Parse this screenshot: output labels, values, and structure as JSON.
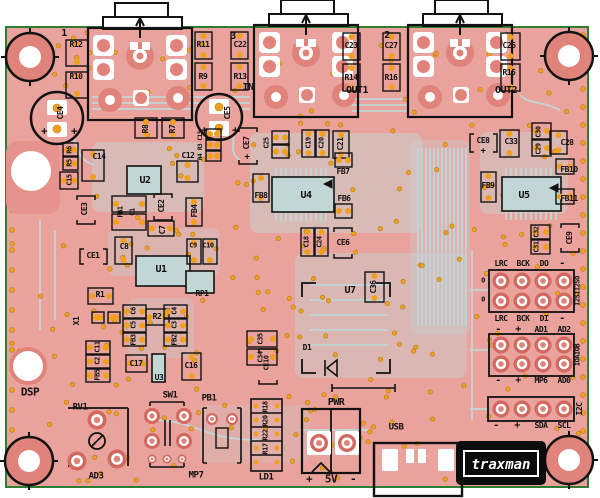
{
  "board": {
    "name": "audio DSP PCB layout",
    "colors": {
      "bg": "#ffffff",
      "board": "#e9a29c",
      "trace": "#c3d6d6",
      "pad_red": "#d4675f",
      "pad_light": "#df837b",
      "via": "#f0a01e",
      "via_ring": "#b57b12",
      "silk": "#121212",
      "white": "#ffffff",
      "edge_green": "#2f7d32"
    }
  },
  "logo": {
    "text": "traxman"
  },
  "labels": [
    {
      "id": "marker-1",
      "t": "1",
      "x": 64,
      "y": 34,
      "s": 10
    },
    {
      "id": "marker-3",
      "t": "3",
      "x": 233,
      "y": 37,
      "s": 10
    },
    {
      "id": "marker-2",
      "t": "2",
      "x": 387,
      "y": 36,
      "s": 10
    },
    {
      "id": "r12",
      "t": "R12",
      "x": 76,
      "y": 45
    },
    {
      "id": "r10",
      "t": "R10",
      "x": 76,
      "y": 77
    },
    {
      "id": "r11",
      "t": "R11",
      "x": 203,
      "y": 45
    },
    {
      "id": "r9",
      "t": "R9",
      "x": 203,
      "y": 77
    },
    {
      "id": "c22",
      "t": "C22",
      "x": 240,
      "y": 45
    },
    {
      "id": "r13",
      "t": "R13",
      "x": 240,
      "y": 77
    },
    {
      "id": "c23",
      "t": "C23",
      "x": 351,
      "y": 46
    },
    {
      "id": "c27",
      "t": "C27",
      "x": 391,
      "y": 46
    },
    {
      "id": "r14",
      "t": "R14",
      "x": 351,
      "y": 78
    },
    {
      "id": "r16",
      "t": "R16",
      "x": 391,
      "y": 78
    },
    {
      "id": "c26",
      "t": "C26",
      "x": 509,
      "y": 46
    },
    {
      "id": "r15",
      "t": "R15",
      "x": 509,
      "y": 73
    },
    {
      "id": "in",
      "t": "IN",
      "x": 248,
      "y": 88,
      "s": 10
    },
    {
      "id": "out1",
      "t": "OUT1",
      "x": 357,
      "y": 91,
      "s": 10
    },
    {
      "id": "out2",
      "t": "OUT2",
      "x": 506,
      "y": 91,
      "s": 10
    },
    {
      "id": "ce4",
      "t": "CE4",
      "x": 61,
      "y": 113,
      "r": -90
    },
    {
      "id": "ce4-plus-l",
      "t": "+",
      "x": 44,
      "y": 131,
      "s": 11
    },
    {
      "id": "ce4-plus-r",
      "t": "+",
      "x": 74,
      "y": 131,
      "s": 11
    },
    {
      "id": "ce5",
      "t": "CE5",
      "x": 228,
      "y": 113,
      "r": -90
    },
    {
      "id": "ce5-plus-l",
      "t": "+",
      "x": 204,
      "y": 130,
      "s": 11
    },
    {
      "id": "ce5-plus-r",
      "t": "+",
      "x": 235,
      "y": 130,
      "s": 11
    },
    {
      "id": "r8",
      "t": "R8",
      "x": 146,
      "y": 129,
      "r": -90
    },
    {
      "id": "r7",
      "t": "R7",
      "x": 173,
      "y": 129,
      "r": -90
    },
    {
      "id": "c13",
      "t": "C13",
      "x": 201,
      "y": 136,
      "r": -90,
      "s": 6
    },
    {
      "id": "r3",
      "t": "R3",
      "x": 201,
      "y": 147,
      "r": -90,
      "s": 6
    },
    {
      "id": "r4",
      "t": "R4",
      "x": 201,
      "y": 157,
      "r": -90,
      "s": 6
    },
    {
      "id": "ce7",
      "t": "CE7",
      "x": 247,
      "y": 143,
      "r": -90
    },
    {
      "id": "ce7-plus",
      "t": "+",
      "x": 247,
      "y": 158,
      "s": 9
    },
    {
      "id": "c25",
      "t": "C25",
      "x": 267,
      "y": 143,
      "r": -90,
      "s": 7
    },
    {
      "id": "c19",
      "t": "C19",
      "x": 309,
      "y": 143,
      "r": -90,
      "s": 7
    },
    {
      "id": "c20",
      "t": "C20",
      "x": 322,
      "y": 143,
      "r": -90,
      "s": 7
    },
    {
      "id": "c21",
      "t": "C21",
      "x": 341,
      "y": 144,
      "r": -90
    },
    {
      "id": "r6",
      "t": "R6",
      "x": 70,
      "y": 150,
      "r": -90,
      "s": 7
    },
    {
      "id": "r5",
      "t": "R5",
      "x": 70,
      "y": 163,
      "r": -90,
      "s": 7
    },
    {
      "id": "c15",
      "t": "C15",
      "x": 70,
      "y": 180,
      "r": -90,
      "s": 7
    },
    {
      "id": "c14",
      "t": "C14",
      "x": 99,
      "y": 157
    },
    {
      "id": "c12",
      "t": "C12",
      "x": 188,
      "y": 156
    },
    {
      "id": "u2",
      "t": "U2",
      "x": 145,
      "y": 181,
      "s": 10
    },
    {
      "id": "ce3",
      "t": "CE3",
      "x": 85,
      "y": 209,
      "r": -90
    },
    {
      "id": "fb1",
      "t": "FB1",
      "x": 121,
      "y": 212,
      "r": -90,
      "s": 7
    },
    {
      "id": "c1",
      "t": "C1",
      "x": 133,
      "y": 212,
      "r": -90,
      "s": 7
    },
    {
      "id": "ce2",
      "t": "CE2",
      "x": 162,
      "y": 206,
      "r": -90
    },
    {
      "id": "c7",
      "t": "C7",
      "x": 163,
      "y": 230,
      "r": -90
    },
    {
      "id": "fb4",
      "t": "FB4",
      "x": 195,
      "y": 211,
      "r": -90
    },
    {
      "id": "c8",
      "t": "C8",
      "x": 124,
      "y": 247
    },
    {
      "id": "c9",
      "t": "C9",
      "x": 193,
      "y": 246,
      "s": 7
    },
    {
      "id": "c10",
      "t": "C10",
      "x": 208,
      "y": 246,
      "s": 7
    },
    {
      "id": "ce1",
      "t": "CE1",
      "x": 93,
      "y": 256
    },
    {
      "id": "u1",
      "t": "U1",
      "x": 161,
      "y": 270,
      "s": 10
    },
    {
      "id": "r1",
      "t": "R1",
      "x": 100,
      "y": 295
    },
    {
      "id": "x1",
      "t": "X1",
      "x": 77,
      "y": 321,
      "r": -90
    },
    {
      "id": "c11",
      "t": "C11",
      "x": 98,
      "y": 347,
      "r": -90,
      "s": 7
    },
    {
      "id": "c2",
      "t": "C2",
      "x": 98,
      "y": 361,
      "r": -90,
      "s": 7
    },
    {
      "id": "fb5",
      "t": "FB5",
      "x": 98,
      "y": 375,
      "r": -90,
      "s": 7
    },
    {
      "id": "r2",
      "t": "R2",
      "x": 157,
      "y": 317
    },
    {
      "id": "c6",
      "t": "C6",
      "x": 134,
      "y": 311,
      "r": -90,
      "s": 7
    },
    {
      "id": "c5",
      "t": "C5",
      "x": 134,
      "y": 325,
      "r": -90,
      "s": 7
    },
    {
      "id": "fb3",
      "t": "FB3",
      "x": 134,
      "y": 340,
      "r": -90,
      "s": 7
    },
    {
      "id": "c4",
      "t": "C4",
      "x": 175,
      "y": 311,
      "r": -90,
      "s": 7
    },
    {
      "id": "c3",
      "t": "C3",
      "x": 175,
      "y": 325,
      "r": -90,
      "s": 7
    },
    {
      "id": "fb2",
      "t": "FB2",
      "x": 175,
      "y": 340,
      "r": -90,
      "s": 7
    },
    {
      "id": "c17",
      "t": "C17",
      "x": 136,
      "y": 364
    },
    {
      "id": "u3",
      "t": "U3",
      "x": 159,
      "y": 378
    },
    {
      "id": "c16",
      "t": "C16",
      "x": 191,
      "y": 366
    },
    {
      "id": "rp1",
      "t": "RP1",
      "x": 202,
      "y": 294
    },
    {
      "id": "c35",
      "t": "C35",
      "x": 261,
      "y": 339,
      "r": -90,
      "s": 7
    },
    {
      "id": "c34",
      "t": "C34",
      "x": 261,
      "y": 357,
      "r": -90,
      "s": 7
    },
    {
      "id": "u7",
      "t": "U7",
      "x": 350,
      "y": 291,
      "s": 10
    },
    {
      "id": "c36",
      "t": "C36",
      "x": 374,
      "y": 287,
      "r": -90
    },
    {
      "id": "ce10",
      "t": "CE10",
      "x": 267,
      "y": 363,
      "r": -90,
      "s": 7
    },
    {
      "id": "d1",
      "t": "D1",
      "x": 307,
      "y": 348
    },
    {
      "id": "ce6",
      "t": "CE6",
      "x": 343,
      "y": 243
    },
    {
      "id": "c18",
      "t": "C18",
      "x": 307,
      "y": 242,
      "r": -90,
      "s": 7
    },
    {
      "id": "c24",
      "t": "C24",
      "x": 320,
      "y": 242,
      "r": -90,
      "s": 7
    },
    {
      "id": "fb8",
      "t": "FB8",
      "x": 261,
      "y": 196
    },
    {
      "id": "u4",
      "t": "U4",
      "x": 306,
      "y": 196,
      "s": 10
    },
    {
      "id": "fb7",
      "t": "FB7",
      "x": 343,
      "y": 172
    },
    {
      "id": "fb6",
      "t": "FB6",
      "x": 344,
      "y": 199
    },
    {
      "id": "ce8",
      "t": "CE8",
      "x": 483,
      "y": 141
    },
    {
      "id": "ce8-plus",
      "t": "+",
      "x": 483,
      "y": 152,
      "s": 9
    },
    {
      "id": "c33",
      "t": "C33",
      "x": 511,
      "y": 142
    },
    {
      "id": "c30",
      "t": "C30",
      "x": 539,
      "y": 132,
      "r": -90,
      "s": 7
    },
    {
      "id": "c29",
      "t": "C29",
      "x": 539,
      "y": 149,
      "r": -90,
      "s": 7
    },
    {
      "id": "c28",
      "t": "C28",
      "x": 567,
      "y": 143
    },
    {
      "id": "fb10",
      "t": "FB10",
      "x": 569,
      "y": 170
    },
    {
      "id": "fb9",
      "t": "FB9",
      "x": 488,
      "y": 186
    },
    {
      "id": "u5",
      "t": "U5",
      "x": 524,
      "y": 196,
      "s": 10
    },
    {
      "id": "fb11",
      "t": "FB11",
      "x": 569,
      "y": 199
    },
    {
      "id": "c32",
      "t": "C32",
      "x": 537,
      "y": 232,
      "r": -90,
      "s": 7
    },
    {
      "id": "c31",
      "t": "C31",
      "x": 537,
      "y": 247,
      "r": -90,
      "s": 7
    },
    {
      "id": "ce9",
      "t": "CE9",
      "x": 570,
      "y": 238,
      "r": -90
    },
    {
      "id": "hdr1-lrc",
      "t": "LRC",
      "x": 501,
      "y": 264
    },
    {
      "id": "hdr1-bck",
      "t": "BCK",
      "x": 523,
      "y": 264
    },
    {
      "id": "hdr1-do",
      "t": "DO",
      "x": 544,
      "y": 264
    },
    {
      "id": "hdr1-dash",
      "t": "-",
      "x": 562,
      "y": 264,
      "s": 10
    },
    {
      "id": "hdr1-o1",
      "t": "0",
      "x": 483,
      "y": 281,
      "s": 7
    },
    {
      "id": "hdr1-o2",
      "t": "0",
      "x": 483,
      "y": 300,
      "s": 7
    },
    {
      "id": "hdr1b-lrc",
      "t": "LRC",
      "x": 501,
      "y": 319
    },
    {
      "id": "hdr1b-bck",
      "t": "BCK",
      "x": 523,
      "y": 319
    },
    {
      "id": "hdr1b-di",
      "t": "DI",
      "x": 544,
      "y": 319
    },
    {
      "id": "hdr1b-dash",
      "t": "-",
      "x": 562,
      "y": 319,
      "s": 10
    },
    {
      "id": "i2s-vertical",
      "t": "I2SII2SO",
      "x": 578,
      "y": 291,
      "r": -90,
      "s": 7
    },
    {
      "id": "hdr2-dash",
      "t": "-",
      "x": 498,
      "y": 330,
      "s": 10
    },
    {
      "id": "hdr2-plus",
      "t": "+",
      "x": 518,
      "y": 330,
      "s": 10
    },
    {
      "id": "hdr2-ad1",
      "t": "AD1",
      "x": 541,
      "y": 330
    },
    {
      "id": "hdr2-ad2",
      "t": "AD2",
      "x": 564,
      "y": 330
    },
    {
      "id": "ioab-vertical",
      "t": "IOAIOB",
      "x": 578,
      "y": 355,
      "r": -90,
      "s": 7
    },
    {
      "id": "hdr2b-dash",
      "t": "-",
      "x": 498,
      "y": 381,
      "s": 10
    },
    {
      "id": "hdr2b-plus",
      "t": "+",
      "x": 518,
      "y": 381,
      "s": 10
    },
    {
      "id": "hdr2b-mp6",
      "t": "MP6",
      "x": 541,
      "y": 381
    },
    {
      "id": "hdr2b-ad0",
      "t": "AD0",
      "x": 564,
      "y": 381
    },
    {
      "id": "i2c-vertical",
      "t": "I2C",
      "x": 580,
      "y": 409,
      "r": -90
    },
    {
      "id": "hdr3-dash",
      "t": "-",
      "x": 496,
      "y": 426,
      "s": 10
    },
    {
      "id": "hdr3-plus",
      "t": "+",
      "x": 517,
      "y": 426,
      "s": 10
    },
    {
      "id": "hdr3-sda",
      "t": "SDA",
      "x": 541,
      "y": 426
    },
    {
      "id": "hdr3-scl",
      "t": "SCL",
      "x": 564,
      "y": 426
    },
    {
      "id": "dsp",
      "t": "DSP",
      "x": 30,
      "y": 392,
      "s": 11
    },
    {
      "id": "rv1",
      "t": "RV1",
      "x": 80,
      "y": 408,
      "s": 9
    },
    {
      "id": "ad3",
      "t": "AD3",
      "x": 96,
      "y": 477,
      "s": 9
    },
    {
      "id": "sw1",
      "t": "SW1",
      "x": 170,
      "y": 396,
      "s": 9
    },
    {
      "id": "mp7",
      "t": "MP7",
      "x": 196,
      "y": 476,
      "s": 9
    },
    {
      "id": "pb1",
      "t": "PB1",
      "x": 209,
      "y": 399,
      "s": 9
    },
    {
      "id": "ld1",
      "t": "LD1",
      "x": 266,
      "y": 478,
      "s": 9
    },
    {
      "id": "r18",
      "t": "R18",
      "x": 266,
      "y": 407,
      "r": -90,
      "s": 7
    },
    {
      "id": "r20",
      "t": "R20",
      "x": 266,
      "y": 421,
      "r": -90,
      "s": 7
    },
    {
      "id": "r22",
      "t": "R22",
      "x": 266,
      "y": 435,
      "r": -90,
      "s": 7
    },
    {
      "id": "r17",
      "t": "R17",
      "x": 266,
      "y": 449,
      "r": -90,
      "s": 7
    },
    {
      "id": "pwr",
      "t": "PWR",
      "x": 336,
      "y": 403,
      "s": 10
    },
    {
      "id": "pwr-plus",
      "t": "+",
      "x": 309,
      "y": 479,
      "s": 11
    },
    {
      "id": "pwr-5v",
      "t": "5V",
      "x": 331,
      "y": 479,
      "s": 11
    },
    {
      "id": "pwr-minus",
      "t": "-",
      "x": 353,
      "y": 479,
      "s": 11
    },
    {
      "id": "usb",
      "t": "USB",
      "x": 396,
      "y": 428,
      "s": 9
    }
  ]
}
